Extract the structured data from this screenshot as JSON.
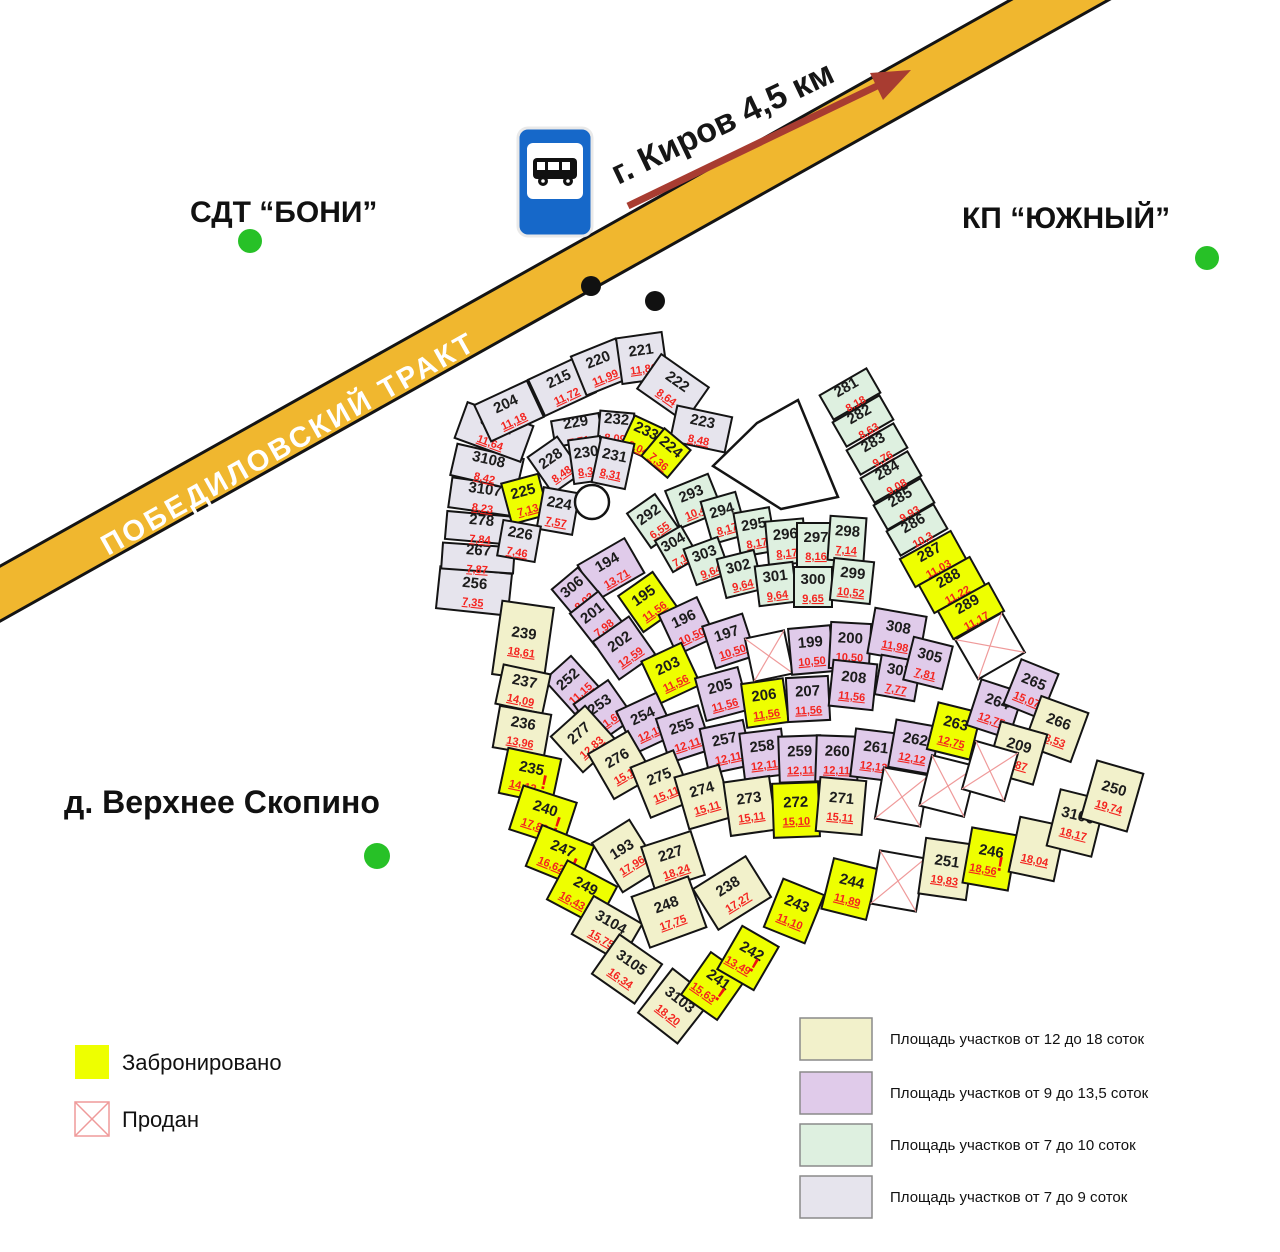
{
  "labels": {
    "sdt": "СДТ “БОНИ”",
    "kp": "КП “ЮЖНЫЙ”",
    "village": "д. Верхнее Скопино",
    "road": "ПОБЕДИЛОВСКИЙ ТРАКТ",
    "direction": "г. Киров 4,5 км"
  },
  "legend": {
    "reserved_label": "Забронировано",
    "sold_label": "Продан",
    "size_classes": [
      {
        "label": "Площадь участков от 12 до 18 соток",
        "color": "#f2f1cb"
      },
      {
        "label": "Площадь участков от 9 до 13,5 соток",
        "color": "#e0cbea"
      },
      {
        "label": "Площадь участков от 7 до 10 соток",
        "color": "#def0e0"
      },
      {
        "label": "Площадь участков от 7 до 9 соток",
        "color": "#e6e4ed"
      }
    ]
  },
  "colors": {
    "reserved": "#eeff00",
    "sold_fill": "#ffffff",
    "sold_cross": "#ef9a9a",
    "beige": "#f2f1cb",
    "purple": "#e0cbea",
    "mint": "#def0e0",
    "grey": "#e6e4ed",
    "stroke": "#141414",
    "road": "#f0b72f",
    "arrow": "#a83c31",
    "green_dot": "#27c127",
    "black_dot": "#111111",
    "bus_blue": "#1668c9"
  },
  "map": {
    "plots": [
      {
        "n": "256",
        "a": "7,35",
        "t": "g",
        "x": 474,
        "y": 591,
        "w": 72,
        "h": 42,
        "r": 6
      },
      {
        "n": "267",
        "a": "7,87",
        "t": "g",
        "x": 478,
        "y": 558,
        "w": 72,
        "h": 26,
        "r": 4
      },
      {
        "n": "278",
        "a": "7,84",
        "t": "g",
        "x": 481,
        "y": 528,
        "w": 70,
        "h": 28,
        "r": 5
      },
      {
        "n": "3107",
        "a": "8,23",
        "t": "g",
        "x": 484,
        "y": 497,
        "w": 68,
        "h": 30,
        "r": 8
      },
      {
        "n": "3108",
        "a": "8,42",
        "t": "g",
        "x": 487,
        "y": 467,
        "w": 68,
        "h": 32,
        "r": 13
      },
      {
        "n": "3102",
        "a": "11,64",
        "t": "g",
        "x": 494,
        "y": 432,
        "w": 70,
        "h": 38,
        "r": 20
      },
      {
        "n": "204",
        "a": "11,18",
        "t": "g",
        "x": 509,
        "y": 411,
        "w": 58,
        "h": 40,
        "r": -25
      },
      {
        "n": "215",
        "a": "11,72",
        "t": "g",
        "x": 562,
        "y": 386,
        "w": 56,
        "h": 40,
        "r": -25
      },
      {
        "n": "220",
        "a": "11,99",
        "t": "g",
        "x": 601,
        "y": 367,
        "w": 48,
        "h": 42,
        "r": -22
      },
      {
        "n": "221",
        "a": "11,86",
        "t": "g",
        "x": 642,
        "y": 358,
        "w": 46,
        "h": 46,
        "r": -8
      },
      {
        "n": "222",
        "a": "8,64",
        "t": "g",
        "x": 673,
        "y": 388,
        "w": 58,
        "h": 42,
        "r": 35
      },
      {
        "n": "223",
        "a": "8,48",
        "t": "g",
        "x": 701,
        "y": 429,
        "w": 56,
        "h": 36,
        "r": 12
      },
      {
        "n": "229",
        "a": "7,71",
        "t": "g",
        "x": 577,
        "y": 430,
        "w": 48,
        "h": 26,
        "r": -10
      },
      {
        "n": "232",
        "a": "8,09",
        "t": "g",
        "x": 616,
        "y": 427,
        "w": 34,
        "h": 30,
        "r": 5
      },
      {
        "n": "233",
        "a": "8,04",
        "t": "y",
        "x": 643,
        "y": 438,
        "w": 34,
        "h": 34,
        "r": 25
      },
      {
        "n": "224",
        "a": "7,36",
        "t": "y",
        "x": 666,
        "y": 453,
        "w": 34,
        "h": 36,
        "r": 40
      },
      {
        "n": "228",
        "a": "8,48",
        "t": "g",
        "x": 555,
        "y": 465,
        "w": 36,
        "h": 44,
        "r": -35
      },
      {
        "n": "230",
        "a": "8,30",
        "t": "g",
        "x": 587,
        "y": 460,
        "w": 32,
        "h": 44,
        "r": -8
      },
      {
        "n": "231",
        "a": "8,31",
        "t": "g",
        "x": 613,
        "y": 463,
        "w": 34,
        "h": 46,
        "r": 12
      },
      {
        "n": "225",
        "a": "7,13",
        "t": "y",
        "x": 525,
        "y": 499,
        "w": 38,
        "h": 42,
        "r": -15
      },
      {
        "n": "224",
        "a": "7,57",
        "t": "g",
        "x": 558,
        "y": 511,
        "w": 36,
        "h": 42,
        "r": 10
      },
      {
        "n": "226",
        "a": "7,46",
        "t": "g",
        "x": 519,
        "y": 541,
        "w": 38,
        "h": 36,
        "r": 10
      },
      {
        "n": "281",
        "a": "8,18",
        "t": "m",
        "x": 850,
        "y": 394,
        "w": 54,
        "h": 28,
        "r": -30
      },
      {
        "n": "282",
        "a": "8,63",
        "t": "m",
        "x": 863,
        "y": 421,
        "w": 54,
        "h": 28,
        "r": -30
      },
      {
        "n": "283",
        "a": "9,76",
        "t": "m",
        "x": 877,
        "y": 449,
        "w": 54,
        "h": 28,
        "r": -30
      },
      {
        "n": "284",
        "a": "9,08",
        "t": "m",
        "x": 891,
        "y": 477,
        "w": 54,
        "h": 28,
        "r": -30
      },
      {
        "n": "285",
        "a": "9,93",
        "t": "m",
        "x": 904,
        "y": 504,
        "w": 54,
        "h": 28,
        "r": -30
      },
      {
        "n": "286",
        "a": "10,3",
        "t": "m",
        "x": 917,
        "y": 530,
        "w": 54,
        "h": 28,
        "r": -30
      },
      {
        "n": "287",
        "a": "11,03",
        "t": "y",
        "x": 933,
        "y": 559,
        "w": 58,
        "h": 32,
        "r": -29
      },
      {
        "n": "288",
        "a": "11,22",
        "t": "y",
        "x": 952,
        "y": 585,
        "w": 58,
        "h": 32,
        "r": -29
      },
      {
        "n": "289",
        "a": "11,17",
        "t": "y",
        "x": 971,
        "y": 611,
        "w": 58,
        "h": 32,
        "r": -29
      },
      {
        "n": "",
        "a": "",
        "t": "x",
        "x": 990,
        "y": 646,
        "w": 54,
        "h": 46,
        "r": -30
      },
      {
        "n": "292",
        "a": "6,55",
        "t": "m",
        "x": 653,
        "y": 521,
        "w": 34,
        "h": 42,
        "r": -35
      },
      {
        "n": "293",
        "a": "10,41",
        "t": "m",
        "x": 694,
        "y": 501,
        "w": 46,
        "h": 40,
        "r": -22
      },
      {
        "n": "294",
        "a": "8,17",
        "t": "m",
        "x": 724,
        "y": 518,
        "w": 36,
        "h": 44,
        "r": -16
      },
      {
        "n": "295",
        "a": "8,17",
        "t": "m",
        "x": 755,
        "y": 532,
        "w": 36,
        "h": 44,
        "r": -10
      },
      {
        "n": "296",
        "a": "8,17",
        "t": "m",
        "x": 786,
        "y": 542,
        "w": 38,
        "h": 44,
        "r": -5
      },
      {
        "n": "297",
        "a": "8,16",
        "t": "m",
        "x": 816,
        "y": 545,
        "w": 38,
        "h": 44,
        "r": 0
      },
      {
        "n": "298",
        "a": "7,14",
        "t": "m",
        "x": 847,
        "y": 539,
        "w": 36,
        "h": 44,
        "r": 4
      },
      {
        "n": "304",
        "a": "7,12",
        "t": "m",
        "x": 677,
        "y": 549,
        "w": 30,
        "h": 36,
        "r": -30
      },
      {
        "n": "303",
        "a": "9,64",
        "t": "m",
        "x": 707,
        "y": 561,
        "w": 36,
        "h": 38,
        "r": -20
      },
      {
        "n": "302",
        "a": "9,64",
        "t": "m",
        "x": 740,
        "y": 574,
        "w": 38,
        "h": 40,
        "r": -14
      },
      {
        "n": "301",
        "a": "9,64",
        "t": "m",
        "x": 776,
        "y": 584,
        "w": 38,
        "h": 40,
        "r": -7
      },
      {
        "n": "300",
        "a": "9,65",
        "t": "m",
        "x": 813,
        "y": 587,
        "w": 38,
        "h": 40,
        "r": 0
      },
      {
        "n": "299",
        "a": "10,52",
        "t": "m",
        "x": 852,
        "y": 581,
        "w": 40,
        "h": 42,
        "r": 6
      },
      {
        "n": "194",
        "a": "13,71",
        "t": "p",
        "x": 611,
        "y": 569,
        "w": 54,
        "h": 40,
        "r": -30
      },
      {
        "n": "306",
        "a": "8,03",
        "t": "p",
        "x": 577,
        "y": 593,
        "w": 34,
        "h": 38,
        "r": -40
      },
      {
        "n": "201",
        "a": "7,98",
        "t": "p",
        "x": 597,
        "y": 619,
        "w": 36,
        "h": 42,
        "r": -38
      },
      {
        "n": "195",
        "a": "11,56",
        "t": "y",
        "x": 648,
        "y": 602,
        "w": 42,
        "h": 44,
        "r": -35
      },
      {
        "n": "202",
        "a": "12,59",
        "t": "p",
        "x": 624,
        "y": 648,
        "w": 44,
        "h": 46,
        "r": -35
      },
      {
        "n": "196",
        "a": "10,50",
        "t": "p",
        "x": 687,
        "y": 626,
        "w": 42,
        "h": 44,
        "r": -25
      },
      {
        "n": "203",
        "a": "11,56",
        "t": "y",
        "x": 671,
        "y": 673,
        "w": 44,
        "h": 46,
        "r": -25
      },
      {
        "n": "197",
        "a": "10,50",
        "t": "p",
        "x": 729,
        "y": 641,
        "w": 42,
        "h": 44,
        "r": -18
      },
      {
        "n": "205",
        "a": "11,56",
        "t": "p",
        "x": 722,
        "y": 694,
        "w": 44,
        "h": 44,
        "r": -15
      },
      {
        "n": "",
        "a": "",
        "t": "x",
        "x": 769,
        "y": 656,
        "w": 40,
        "h": 44,
        "r": -12
      },
      {
        "n": "206",
        "a": "11,56",
        "t": "y",
        "x": 765,
        "y": 703,
        "w": 42,
        "h": 44,
        "r": -8
      },
      {
        "n": "199",
        "a": "10,50",
        "t": "p",
        "x": 811,
        "y": 650,
        "w": 42,
        "h": 46,
        "r": -5
      },
      {
        "n": "200",
        "a": "10,50",
        "t": "p",
        "x": 850,
        "y": 646,
        "w": 40,
        "h": 46,
        "r": 3
      },
      {
        "n": "207",
        "a": "11,56",
        "t": "p",
        "x": 808,
        "y": 699,
        "w": 42,
        "h": 44,
        "r": -3
      },
      {
        "n": "208",
        "a": "11,56",
        "t": "p",
        "x": 853,
        "y": 685,
        "w": 44,
        "h": 46,
        "r": 6
      },
      {
        "n": "308",
        "a": "11,98",
        "t": "p",
        "x": 897,
        "y": 635,
        "w": 52,
        "h": 46,
        "r": 10
      },
      {
        "n": "307",
        "a": "7,77",
        "t": "p",
        "x": 898,
        "y": 678,
        "w": 40,
        "h": 40,
        "r": 10
      },
      {
        "n": "305",
        "a": "7,81",
        "t": "p",
        "x": 928,
        "y": 663,
        "w": 40,
        "h": 44,
        "r": 14
      },
      {
        "n": "252",
        "a": "11,15",
        "t": "p",
        "x": 573,
        "y": 685,
        "w": 36,
        "h": 46,
        "r": -42
      },
      {
        "n": "253",
        "a": "11,60",
        "t": "p",
        "x": 604,
        "y": 711,
        "w": 42,
        "h": 46,
        "r": -35
      },
      {
        "n": "254",
        "a": "12,11",
        "t": "p",
        "x": 646,
        "y": 723,
        "w": 44,
        "h": 46,
        "r": -25
      },
      {
        "n": "255",
        "a": "12,11",
        "t": "p",
        "x": 684,
        "y": 734,
        "w": 44,
        "h": 46,
        "r": -18
      },
      {
        "n": "257",
        "a": "12,11",
        "t": "p",
        "x": 726,
        "y": 747,
        "w": 44,
        "h": 46,
        "r": -12
      },
      {
        "n": "258",
        "a": "12,11",
        "t": "p",
        "x": 763,
        "y": 754,
        "w": 42,
        "h": 46,
        "r": -7
      },
      {
        "n": "259",
        "a": "12,11",
        "t": "p",
        "x": 800,
        "y": 759,
        "w": 42,
        "h": 46,
        "r": -2
      },
      {
        "n": "260",
        "a": "12,11",
        "t": "p",
        "x": 837,
        "y": 759,
        "w": 42,
        "h": 46,
        "r": 2
      },
      {
        "n": "261",
        "a": "12,12",
        "t": "p",
        "x": 875,
        "y": 755,
        "w": 44,
        "h": 48,
        "r": 7
      },
      {
        "n": "262",
        "a": "12,12",
        "t": "p",
        "x": 914,
        "y": 747,
        "w": 44,
        "h": 48,
        "r": 10
      },
      {
        "n": "263",
        "a": "12,75",
        "t": "y",
        "x": 954,
        "y": 731,
        "w": 44,
        "h": 48,
        "r": 14
      },
      {
        "n": "264",
        "a": "12,75",
        "t": "p",
        "x": 995,
        "y": 709,
        "w": 44,
        "h": 48,
        "r": 18
      },
      {
        "n": "265",
        "a": "15,07",
        "t": "p",
        "x": 1031,
        "y": 689,
        "w": 40,
        "h": 48,
        "r": 22
      },
      {
        "n": "266",
        "a": "18,53",
        "t": "b",
        "x": 1056,
        "y": 729,
        "w": 50,
        "h": 52,
        "r": 20
      },
      {
        "n": "209",
        "a": "15,87",
        "t": "b",
        "x": 1017,
        "y": 753,
        "w": 48,
        "h": 52,
        "r": 16
      },
      {
        "n": "239",
        "a": "18,61",
        "t": "b",
        "x": 523,
        "y": 641,
        "w": 52,
        "h": 74,
        "r": 8
      },
      {
        "n": "237",
        "a": "14,09",
        "t": "b",
        "x": 523,
        "y": 689,
        "w": 48,
        "h": 40,
        "r": 12
      },
      {
        "n": "236",
        "a": "13,96",
        "t": "b",
        "x": 522,
        "y": 731,
        "w": 52,
        "h": 42,
        "r": 10
      },
      {
        "n": "235",
        "a": "14,12",
        "t": "y",
        "x": 530,
        "y": 776,
        "w": 54,
        "h": 46,
        "r": 12,
        "e": true
      },
      {
        "n": "240",
        "a": "17,83",
        "t": "y",
        "x": 543,
        "y": 816,
        "w": 56,
        "h": 46,
        "r": 18,
        "e": true
      },
      {
        "n": "247",
        "a": "16,62",
        "t": "y",
        "x": 560,
        "y": 856,
        "w": 56,
        "h": 44,
        "r": 22,
        "e": true
      },
      {
        "n": "249",
        "a": "16,43",
        "t": "y",
        "x": 582,
        "y": 893,
        "w": 56,
        "h": 44,
        "r": 28,
        "e": true
      },
      {
        "n": "3104",
        "a": "15,75",
        "t": "b",
        "x": 607,
        "y": 929,
        "w": 56,
        "h": 44,
        "r": 30
      },
      {
        "n": "3105",
        "a": "16,34",
        "t": "b",
        "x": 627,
        "y": 969,
        "w": 52,
        "h": 48,
        "r": 35
      },
      {
        "n": "277",
        "a": "12,83",
        "t": "b",
        "x": 584,
        "y": 739,
        "w": 46,
        "h": 48,
        "r": -42
      },
      {
        "n": "276",
        "a": "15,10",
        "t": "b",
        "x": 621,
        "y": 765,
        "w": 46,
        "h": 52,
        "r": -30
      },
      {
        "n": "275",
        "a": "15,11",
        "t": "b",
        "x": 662,
        "y": 784,
        "w": 46,
        "h": 54,
        "r": -22
      },
      {
        "n": "274",
        "a": "15,11",
        "t": "b",
        "x": 704,
        "y": 797,
        "w": 46,
        "h": 54,
        "r": -16
      },
      {
        "n": "273",
        "a": "15,11",
        "t": "b",
        "x": 750,
        "y": 806,
        "w": 46,
        "h": 54,
        "r": -8
      },
      {
        "n": "272",
        "a": "15,10",
        "t": "y",
        "x": 796,
        "y": 810,
        "w": 46,
        "h": 54,
        "r": -2
      },
      {
        "n": "271",
        "a": "15,11",
        "t": "b",
        "x": 841,
        "y": 806,
        "w": 46,
        "h": 54,
        "r": 5
      },
      {
        "n": "",
        "a": "",
        "t": "x",
        "x": 902,
        "y": 797,
        "w": 46,
        "h": 52,
        "r": 10
      },
      {
        "n": "",
        "a": "",
        "t": "x",
        "x": 948,
        "y": 786,
        "w": 46,
        "h": 52,
        "r": 14
      },
      {
        "n": "",
        "a": "",
        "t": "x",
        "x": 990,
        "y": 771,
        "w": 44,
        "h": 50,
        "r": 16
      },
      {
        "n": "193",
        "a": "17,96",
        "t": "b",
        "x": 626,
        "y": 856,
        "w": 44,
        "h": 58,
        "r": -32
      },
      {
        "n": "227",
        "a": "18,24",
        "t": "b",
        "x": 673,
        "y": 861,
        "w": 52,
        "h": 46,
        "r": -18
      },
      {
        "n": "248",
        "a": "17,75",
        "t": "b",
        "x": 669,
        "y": 912,
        "w": 60,
        "h": 54,
        "r": -20
      },
      {
        "n": "238",
        "a": "17,27",
        "t": "b",
        "x": 732,
        "y": 893,
        "w": 62,
        "h": 48,
        "r": -32
      },
      {
        "n": "3103",
        "a": "18,20",
        "t": "b",
        "x": 675,
        "y": 1006,
        "w": 50,
        "h": 56,
        "r": 38
      },
      {
        "n": "241",
        "a": "15,63",
        "t": "y",
        "x": 714,
        "y": 986,
        "w": 44,
        "h": 52,
        "r": 35,
        "e": true
      },
      {
        "n": "242",
        "a": "13,49",
        "t": "y",
        "x": 748,
        "y": 958,
        "w": 42,
        "h": 50,
        "r": 30,
        "e": true
      },
      {
        "n": "243",
        "a": "11,10",
        "t": "y",
        "x": 794,
        "y": 911,
        "w": 44,
        "h": 52,
        "r": 22
      },
      {
        "n": "244",
        "a": "11,89",
        "t": "y",
        "x": 850,
        "y": 889,
        "w": 46,
        "h": 52,
        "r": 14
      },
      {
        "n": "",
        "a": "",
        "t": "x",
        "x": 898,
        "y": 881,
        "w": 46,
        "h": 54,
        "r": 10
      },
      {
        "n": "251",
        "a": "19,83",
        "t": "b",
        "x": 946,
        "y": 869,
        "w": 48,
        "h": 56,
        "r": 8
      },
      {
        "n": "246",
        "a": "18,56",
        "t": "y",
        "x": 990,
        "y": 859,
        "w": 46,
        "h": 56,
        "r": 10,
        "e": true
      },
      {
        "n": "",
        "a": "18,04",
        "t": "b",
        "x": 1037,
        "y": 849,
        "w": 46,
        "h": 56,
        "r": 12
      },
      {
        "n": "3106",
        "a": "18,17",
        "t": "b",
        "x": 1076,
        "y": 823,
        "w": 46,
        "h": 58,
        "r": 14
      },
      {
        "n": "250",
        "a": "19,74",
        "t": "b",
        "x": 1112,
        "y": 796,
        "w": 48,
        "h": 60,
        "r": 16
      }
    ]
  }
}
